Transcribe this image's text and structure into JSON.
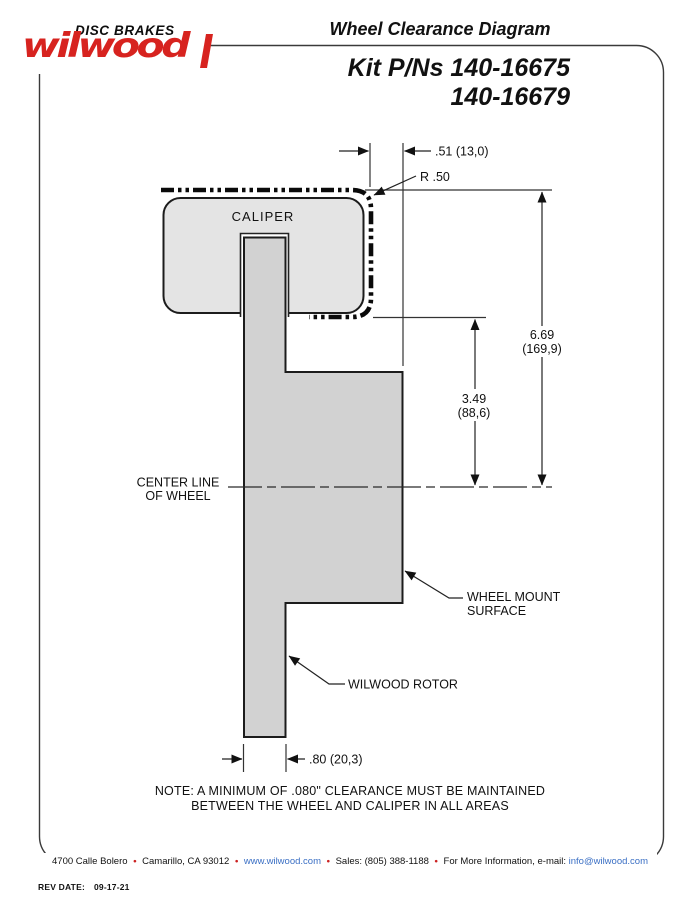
{
  "header": {
    "logo_brand": "wilwood",
    "logo_tagline": "DISC BRAKES",
    "title": "Wheel Clearance Diagram",
    "kit_line1": "Kit P/Ns 140-16675",
    "kit_line2": "140-16679"
  },
  "diagram": {
    "labels": {
      "caliper": "CALIPER",
      "center_line_1": "CENTER LINE",
      "center_line_2": "OF WHEEL",
      "wheel_mount_1": "WHEEL MOUNT",
      "wheel_mount_2": "SURFACE",
      "rotor": "WILWOOD ROTOR"
    },
    "dimensions": {
      "caliper_offset": ".51 (13,0)",
      "corner_radius": "R .50",
      "outer_radius_in": "6.69",
      "outer_radius_mm": "(169,9)",
      "inner_radius_in": "3.49",
      "inner_radius_mm": "(88,6)",
      "rotor_width": ".80 (20,3)"
    },
    "note_line1": "NOTE: A MINIMUM OF .080\" CLEARANCE MUST BE MAINTAINED",
    "note_line2": "BETWEEN THE WHEEL AND CALIPER IN ALL AREAS"
  },
  "footer": {
    "bullet": "•",
    "address": "4700 Calle Bolero",
    "city": "Camarillo, CA 93012",
    "website": "www.wilwood.com",
    "sales": "Sales: (805) 388-1188",
    "info_label": "For More Information, e-mail:",
    "email": "info@wilwood.com",
    "rev_label": "REV DATE:",
    "rev_date": "09-17-21"
  },
  "colors": {
    "brand_red": "#d7231f",
    "link_blue": "#3a6fc4",
    "caliper_fill": "#e4e4e4",
    "rotor_fill": "#d2d2d2"
  }
}
